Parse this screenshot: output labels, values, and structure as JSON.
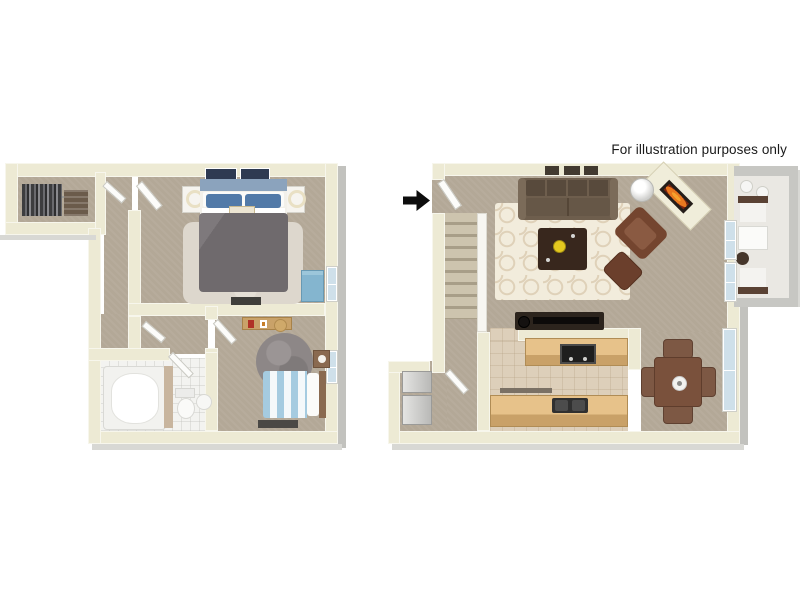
{
  "disclaimer": "For illustration purposes only",
  "icons": {
    "entry_arrow": "solid black right-pointing arrow marking the unit entry door"
  },
  "colors": {
    "wall": "#edead4",
    "wall-shadow": "#d8d2b6",
    "edge-gray": "#c2c2be",
    "edge-light": "#d8d8d4",
    "carpet": "#b3a897",
    "carpet-light": "#c3b8a8",
    "tile-bath": "#f3f3f0",
    "tile-kitchen": "#ddcfba",
    "patio-floor": "#eae8e3",
    "patio-wall": "#c7c7c3",
    "rug-cream": "#f2ecdc",
    "rug-pattern": "#d9c9ae",
    "rug-fluffy": "#ddd7cd",
    "rug-gray": "#8d8787",
    "sofa": "#6e5e4d",
    "sofa-dark": "#584a3c",
    "armchair": "#74452f",
    "ottoman": "#6b3f2c",
    "coffee-table": "#38271d",
    "tv-console": "#2c241d",
    "cabinet": "#e7c28a",
    "cabinet-face": "#c9a168",
    "stove": "#1e1e1e",
    "sink": "#303030",
    "appliance": "#cfcfcd",
    "duvet": "#6f6a6d",
    "headboard": "#8ba3bd",
    "pillow-blue": "#527aa8",
    "bench-blue": "#84b5cf",
    "stripe-blue": "#a5cbe0",
    "bed-white": "#f2f0ea",
    "dining-wood": "#7a513c",
    "chair-wood": "#7d5844",
    "stairs-a": "#cdc4ae",
    "stairs-b": "#a89e88",
    "window-glass": "#cfe0ea",
    "fire-orange": "#e87820",
    "flower-yellow": "#e3c81f",
    "art-navy": "#2e3a52",
    "arrow-black": "#0d0d0d",
    "door-white": "#fcfcfa",
    "text": "#1a1a1a"
  }
}
